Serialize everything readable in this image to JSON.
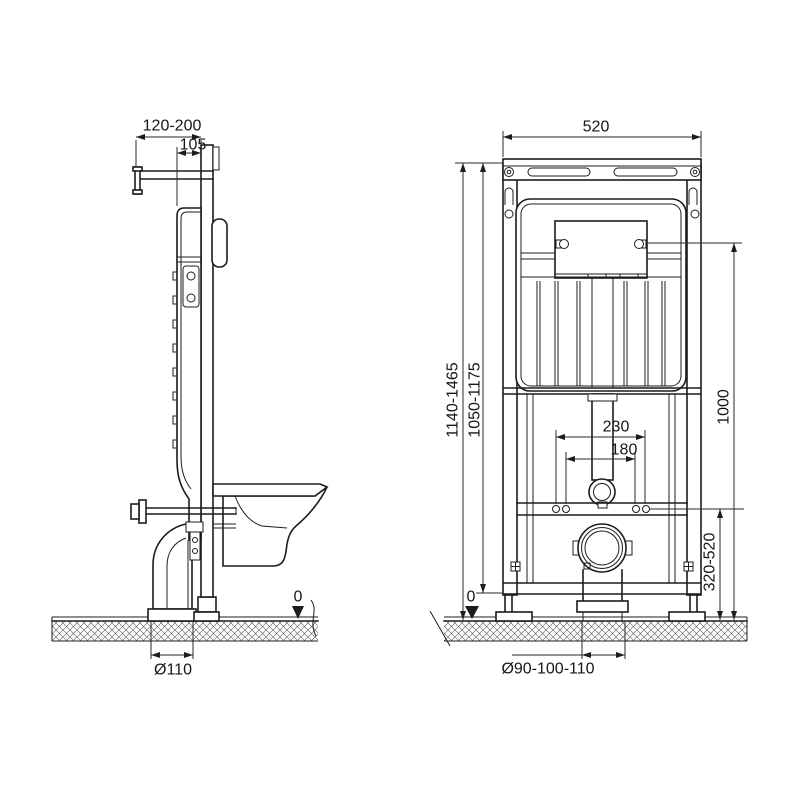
{
  "drawing": {
    "type": "technical-installation-drawing",
    "subject": "wall-hung WC concealed cistern frame, side and front views",
    "background": "#ffffff",
    "line_color": "#1c1c1c",
    "views": {
      "side": {
        "name": "side-view",
        "dims": {
          "wall_offset": "120-200",
          "bracket_offset": "105",
          "floor_level": "0",
          "drain_diameter": "Ø110"
        }
      },
      "front": {
        "name": "front-view",
        "dims": {
          "frame_width": "520",
          "height_range_total": "1140-1465",
          "height_range_frame": "1050-1175",
          "panel_height": "1000",
          "bolt_spacing_outer": "230",
          "bolt_spacing_inner": "180",
          "outlet_height_range": "320-520",
          "floor_level": "0",
          "outlet_diameter": "Ø90-100-110"
        }
      }
    }
  }
}
